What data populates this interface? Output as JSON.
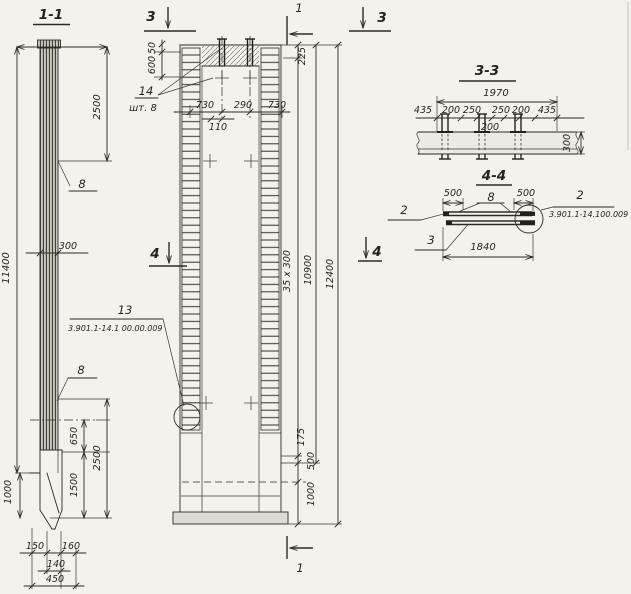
{
  "colors": {
    "paper": "#f4f2ec",
    "ink": "#2e2b26"
  },
  "d": {
    "s11": {
      "title": "1-1",
      "t2500": "2500",
      "t8a": "8",
      "t300": "300",
      "t11400": "11400",
      "t8b": "8",
      "t650": "650",
      "t1500": "1500",
      "t2500b": "2500",
      "t1000": "1000",
      "t150": "150",
      "t160": "160",
      "t140": "140",
      "t450": "450"
    },
    "el": {
      "m3l": "3",
      "m3r": "3",
      "m1t": "1",
      "m1b": "1",
      "m4l": "4",
      "m4r": "4",
      "t50": "50",
      "t600": "600",
      "p14": "14",
      "p14q": "шт. 8",
      "t730a": "730",
      "t290": "290",
      "t730b": "730",
      "t110": "110",
      "t225": "225",
      "t35x300": "35 x 300",
      "t10900": "10900",
      "t12400": "12400",
      "p13": "13",
      "p13ref": "3.901.1-14.1 00.00.009",
      "t175": "175",
      "t500": "500",
      "t1000": "1000"
    },
    "s33": {
      "title": "3-3",
      "t1970": "1970",
      "t435a": "435",
      "t200a": "200",
      "t250a": "250",
      "t250b": "250",
      "t200b": "200",
      "t435b": "435",
      "t200c": "200",
      "t300": "300"
    },
    "s44": {
      "title": "4-4",
      "t500a": "500",
      "p8": "8",
      "t500b": "500",
      "p2a": "2",
      "p3": "3",
      "t1840": "1840",
      "p2b": "2",
      "ref": "3.901.1-14.100.009"
    }
  }
}
